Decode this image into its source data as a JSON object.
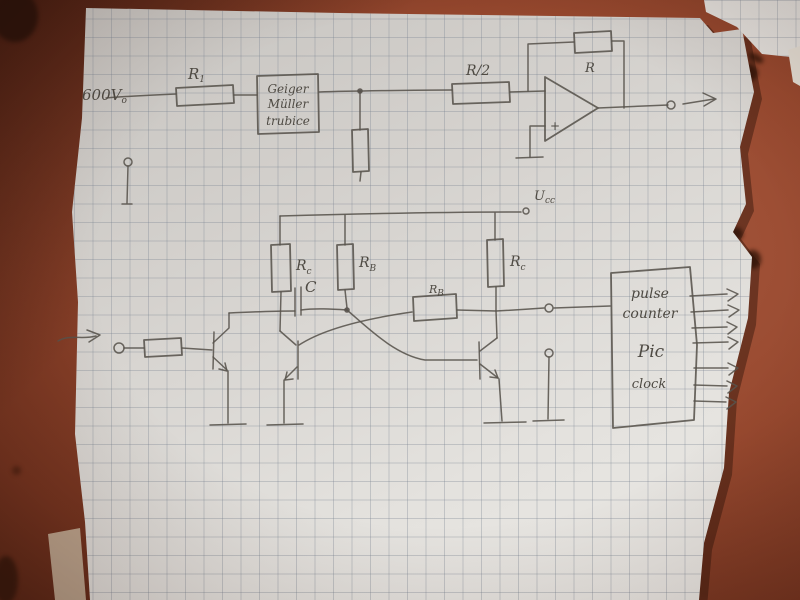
{
  "labels": {
    "supply_voltage": {
      "main": "600V",
      "sub": "o"
    },
    "r1": {
      "main": "R",
      "sub": "1"
    },
    "geiger_box": {
      "line1": "Geiger",
      "line2": "Müller",
      "line3": "trubice"
    },
    "r_half": "R/2",
    "feedback_resistor": "R",
    "opamp_plus": "+",
    "ucc": {
      "main": "U",
      "sub": "cc"
    },
    "rc_left": {
      "main": "R",
      "sub": "c"
    },
    "rb_left": {
      "main": "R",
      "sub": "B"
    },
    "rc_right": {
      "main": "R",
      "sub": "c"
    },
    "capacitor": "C",
    "rb_mid": {
      "main": "R",
      "sub": "B"
    },
    "counter_box": {
      "line1": "pulse",
      "line2": "counter",
      "line3": "Pic",
      "line4": "clock"
    }
  },
  "colors": {
    "table": "#98492f",
    "table_dark": "#572515",
    "paper": "#dcd9d4",
    "grid_line": "#9aa2ac",
    "pencil": "#55504a"
  }
}
